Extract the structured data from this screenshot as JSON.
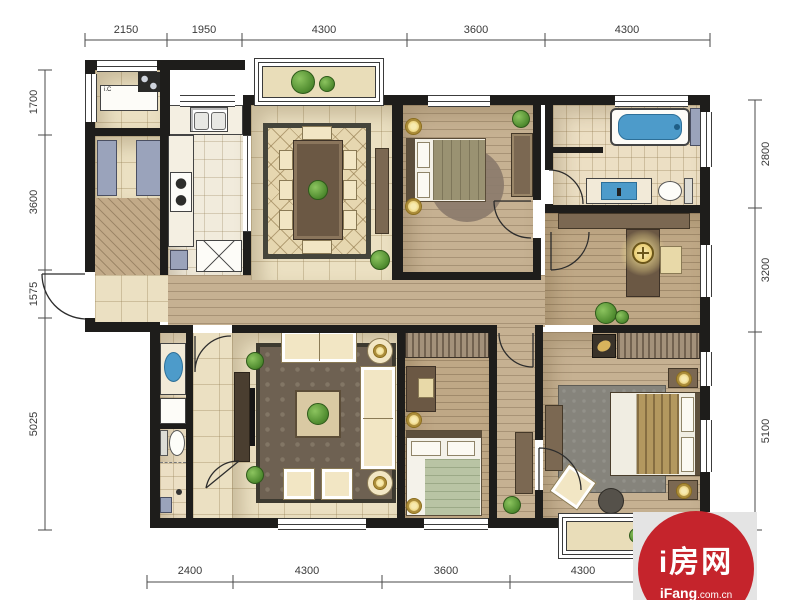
{
  "dimensions": {
    "top": [
      "2150",
      "1950",
      "4300",
      "3600",
      "4300"
    ],
    "left": [
      "1700",
      "3600",
      "1575",
      "5025"
    ],
    "right": [
      "2800",
      "3200",
      "5100"
    ],
    "bottom": [
      "2400",
      "4300",
      "3600",
      "4300"
    ]
  },
  "equipment": {
    "utility_unit_label": "i.C"
  },
  "watermark": {
    "brand": "i房网",
    "domain_bold": "iFang",
    "domain_suffix": ".com.cn"
  },
  "colors": {
    "wall": "#1e1d1b",
    "tile_floor": "#ebe0c2",
    "wood_floor": "#c6b192",
    "water_blue": "#4d9bca",
    "plant_green": "#5d9b3d",
    "lamp_gold": "#e3bf4f",
    "watermark_red": "#c5242c",
    "rug_brown": "#6e6152"
  }
}
